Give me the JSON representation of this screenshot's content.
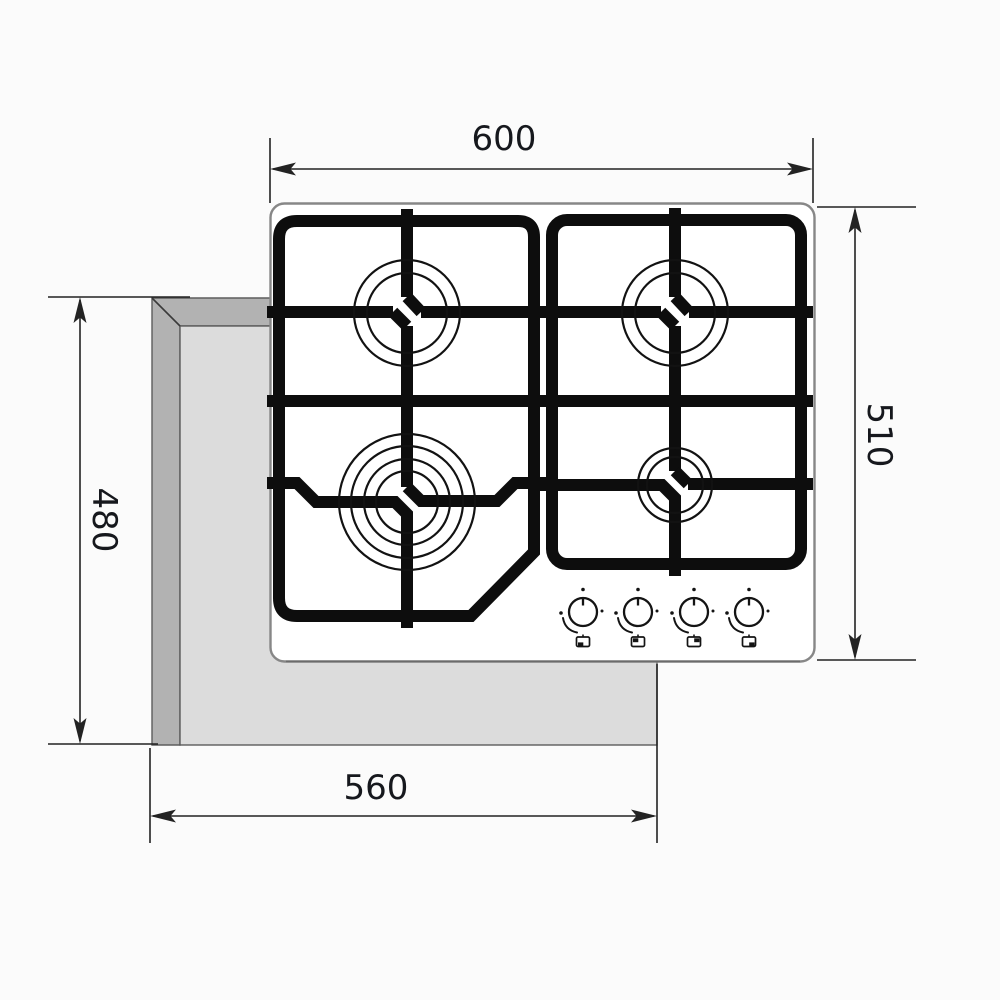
{
  "diagram": {
    "subject": "4-burner gas hob installation drawing, top view",
    "dimensions": {
      "hob_width": "600",
      "hob_depth": "510",
      "cutout_width": "560",
      "cutout_depth": "480"
    },
    "burner_count": "4",
    "knob_count": "4",
    "icons": [
      "control-knob-dial-icon",
      "knob-pointer-icon",
      "flame-level-dot-icon",
      "flame-adjust-arc-icon",
      "burner-position-icon"
    ],
    "colors": {
      "grate_black": "#0d0d0d",
      "dimension_line": "#232323",
      "dimension_text": "#16181d",
      "counter_dark": "#b2b2b2",
      "counter_light": "#dcdcdc",
      "hob_outline": "#878787",
      "background": "#fbfbfb"
    }
  }
}
